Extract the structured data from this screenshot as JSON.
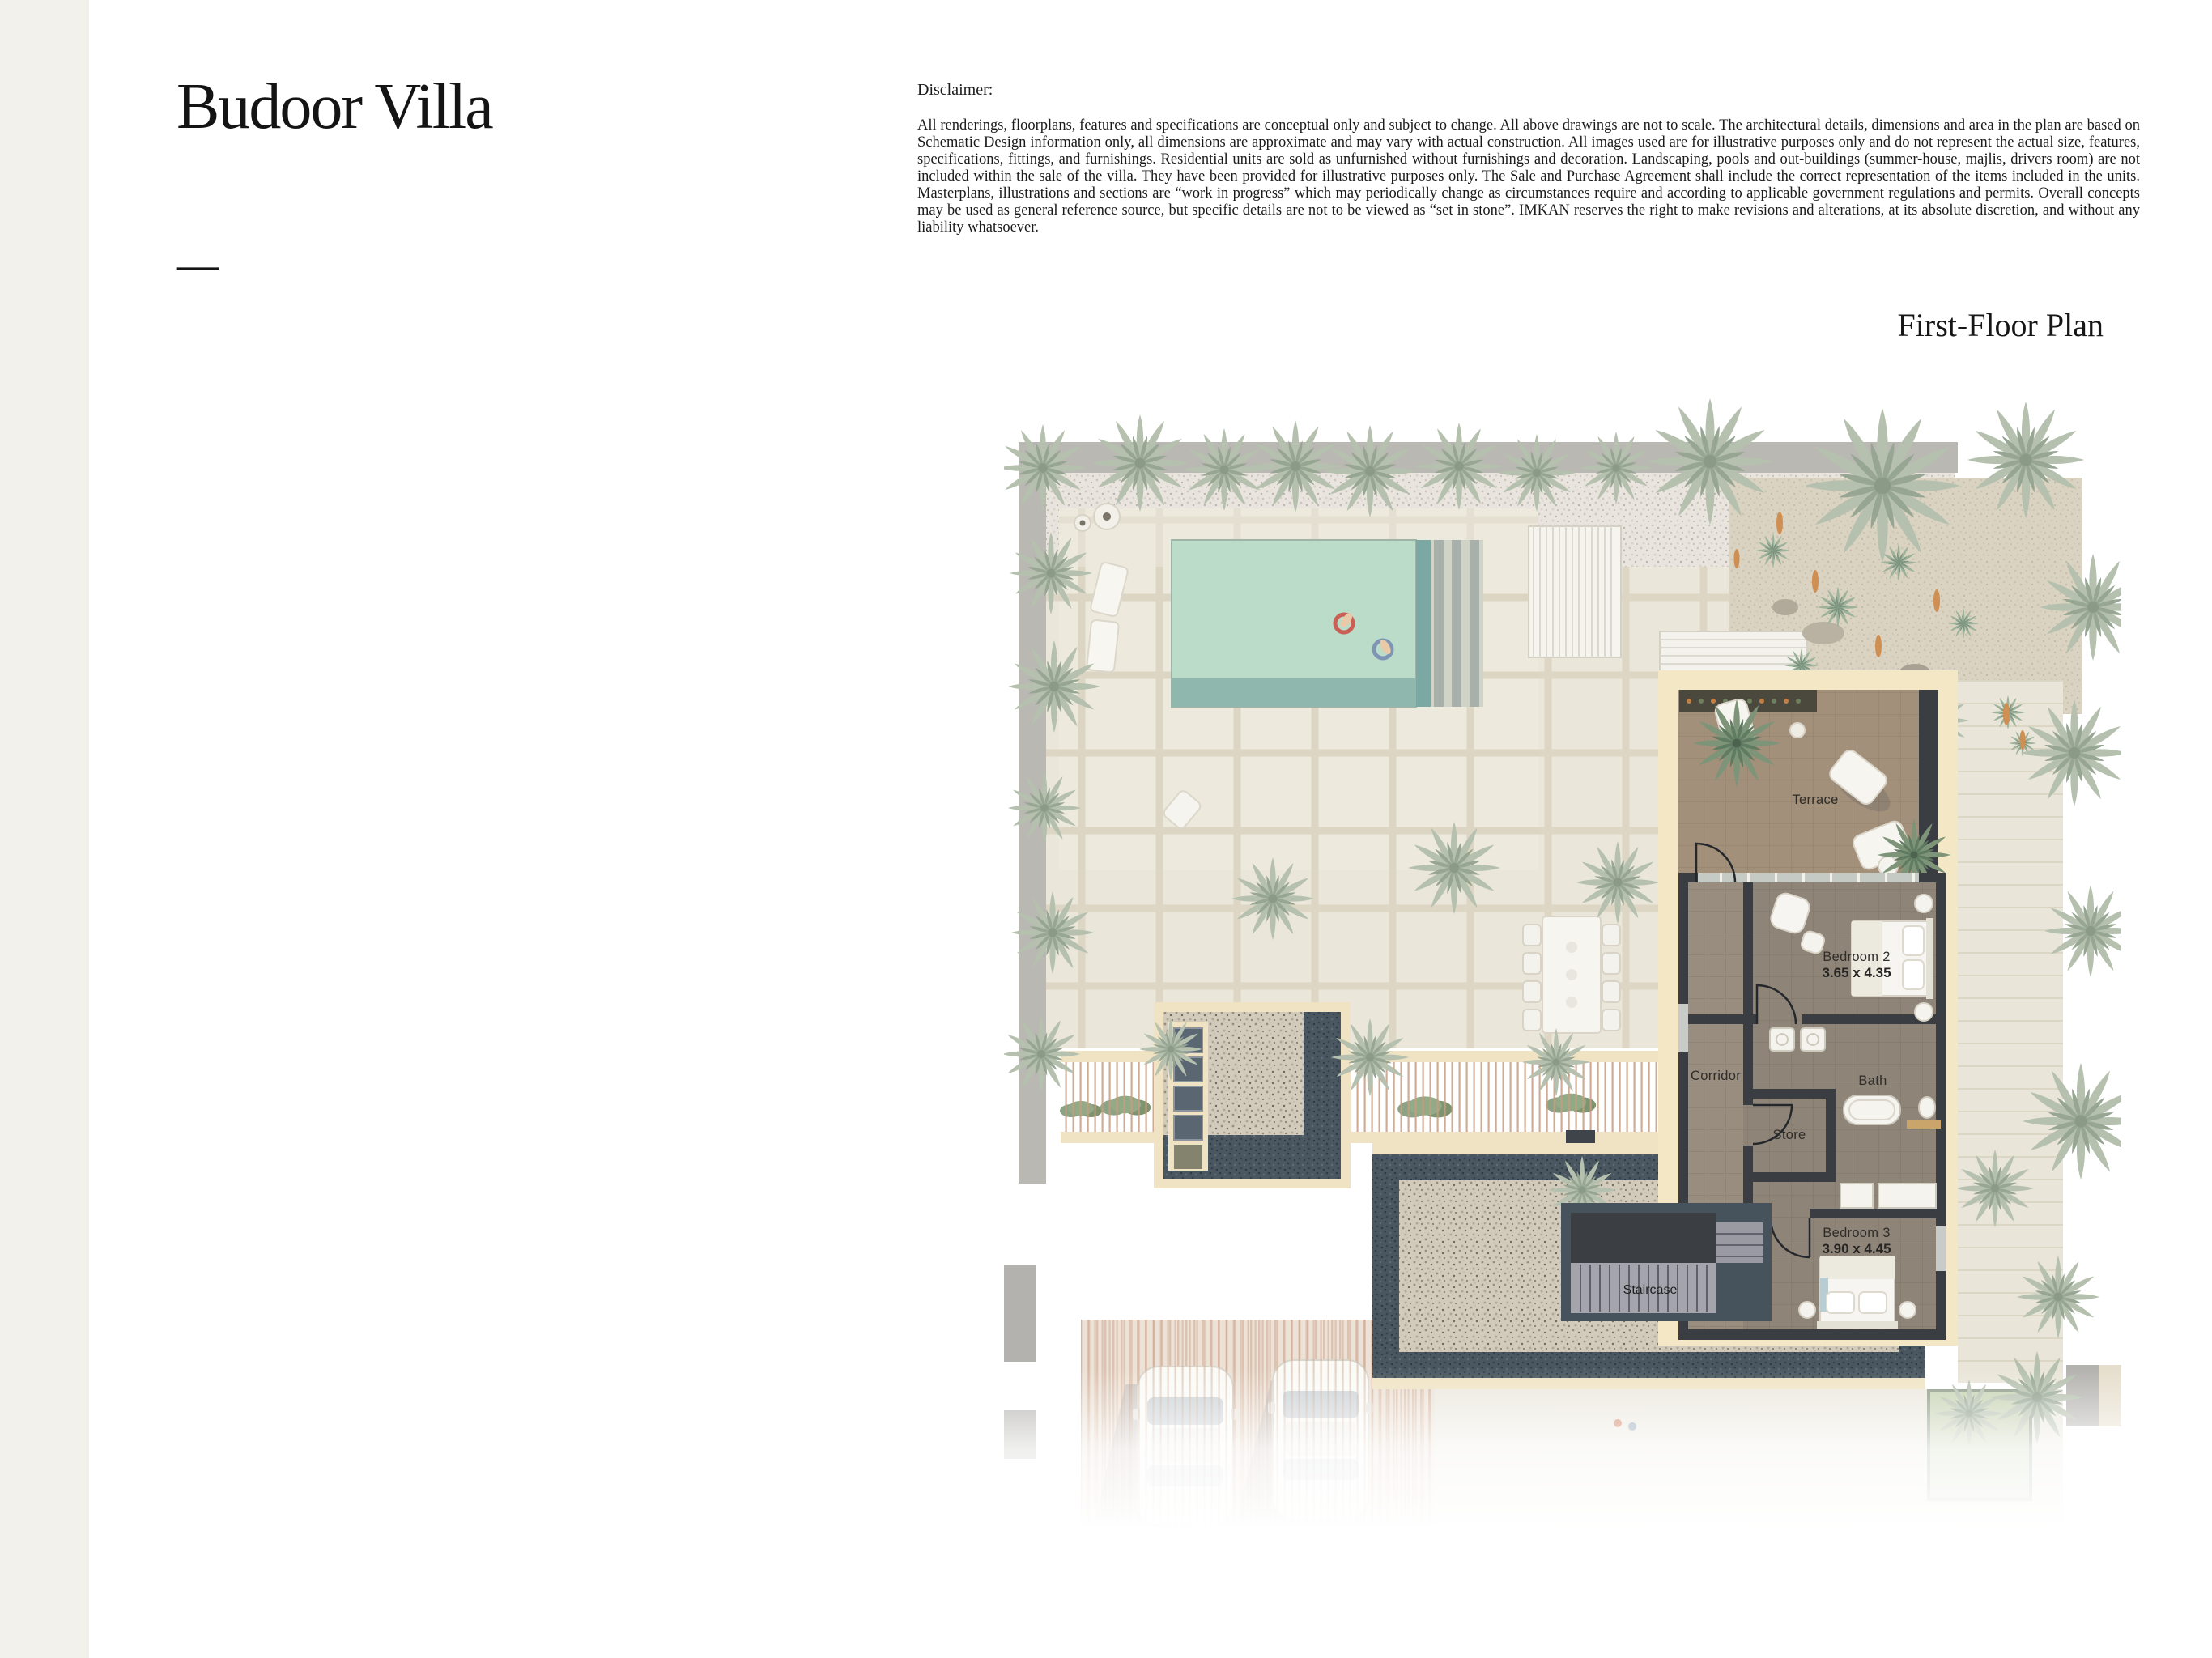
{
  "header": {
    "title": "Budoor Villa",
    "divider": "—"
  },
  "disclaimer": {
    "heading": "Disclaimer:",
    "body": "All renderings, floorplans, features and specifications are conceptual only and subject to change. All above drawings are not to scale. The architectural details, dimensions and area in the plan are based on Schematic Design information only, all dimensions are approximate and may vary with actual construction. All images used are for illustrative purposes only and do not represent the actual size, features, specifications, fittings, and furnishings. Residential units are sold as unfurnished without furnishings and decoration. Landscaping, pools and out-buildings (summer-house, majlis, drivers room) are not included within the sale of the villa. They have been provided for illustrative purposes only. The Sale and Purchase Agreement shall include the correct representation of the items included in the units. Masterplans, illustrations and sections are “work in progress” which may periodically change as circumstances require and according to applicable government regulations and permits. Overall concepts may be used as general reference source, but specific details are not to be viewed as “set in stone”. IMKAN reserves the right to make revisions and alterations, at its absolute discretion, and without any liability whatsoever."
  },
  "plan": {
    "heading": "First-Floor Plan",
    "rooms": [
      {
        "label": "Terrace",
        "dimensions": ""
      },
      {
        "label": "Bedroom 2",
        "dimensions": "3.65 x 4.35"
      },
      {
        "label": "Corridor",
        "dimensions": ""
      },
      {
        "label": "Bath",
        "dimensions": ""
      },
      {
        "label": "Store",
        "dimensions": ""
      },
      {
        "label": "Bedroom 3",
        "dimensions": "3.90 x 4.45"
      },
      {
        "label": "Staircase",
        "dimensions": ""
      }
    ],
    "colors": {
      "pool_water": "#badcc8",
      "terrace_floor": "#a3907a",
      "room_floor": "#8f8478",
      "wall": "#3a3e43",
      "cream_trim": "#f3e7c6",
      "gravel_border": "#47545e",
      "palm_faded": "#b5c0ae",
      "palm_highlight": "#7e9479",
      "left_strip": "#f2f1ec"
    }
  }
}
